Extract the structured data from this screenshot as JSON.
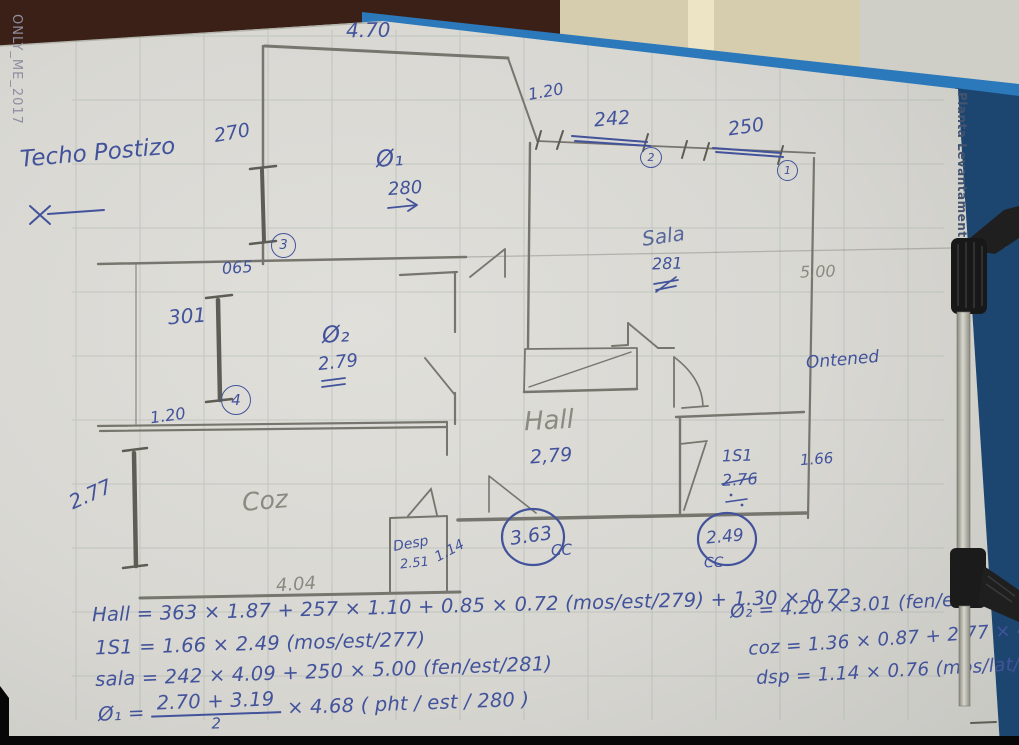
{
  "colors": {
    "pen": "#42539b",
    "pencil": "#83837a",
    "clipboard_blue": "#2b78ba",
    "paper": "#d9d8d3"
  },
  "watermark": "ONLY_ME_2017",
  "side_label": "Planta Levantamento",
  "notes": {
    "ceiling": "Techo Postizo",
    "right_margin": "Ontened"
  },
  "rooms": {
    "q1": {
      "label": "Ø₁",
      "height": "280"
    },
    "q2": {
      "label": "Ø₂",
      "height": "2.79"
    },
    "sala": {
      "label": "Sala",
      "height": "281"
    },
    "hall": {
      "label": "Hall",
      "height": "2,79"
    },
    "coz": {
      "label": "Coz"
    },
    "desp": {
      "label": "Desp",
      "height": "2.51"
    },
    "is1": {
      "label": "1S1",
      "height": "2.76"
    }
  },
  "dims": {
    "top_width": "4.70",
    "window3": "270",
    "window3_no": "3",
    "wall_offset": "065",
    "window4": "301",
    "window4_no": "4",
    "opening_left": "1.20",
    "opening_top": "1.20",
    "window2": "242",
    "window2_no": "2",
    "window1": "250",
    "window1_no": "1",
    "sala_width": "5.00",
    "coz_window": "2.77",
    "coz_width": "4.04",
    "desp_width": "1.14",
    "is1_width": "1.66",
    "hall_door": "3.63",
    "hall_door_tag": "CC",
    "is1_door": "2.49",
    "is1_door_tag": "CC"
  },
  "equations": {
    "hall": "Hall = 363 × 1.87 + 257 × 1.10 + 0.85 × 0.72 (mos/est/279) + 1.30 × 0.72",
    "is1": "1S1 = 1.66 × 2.49 (mos/est/277)",
    "sala": "sala = 242 × 4.09 + 250 × 5.00 (fen/est/281)",
    "q1_lhs": "Ø₁ =",
    "q1_num": "2.70 + 3.19",
    "q1_den": "2",
    "q1_rhs": "× 4.68 ( pht / est / 280 )",
    "q2": "Ø₂ = 4.20 × 3.01 (fen/est/279)",
    "coz": "coz = 1.36 × 0.87 + 2.77 × 4.04",
    "dsp": "dsp = 1.14 × 0.76 (mos/lat/251)"
  }
}
